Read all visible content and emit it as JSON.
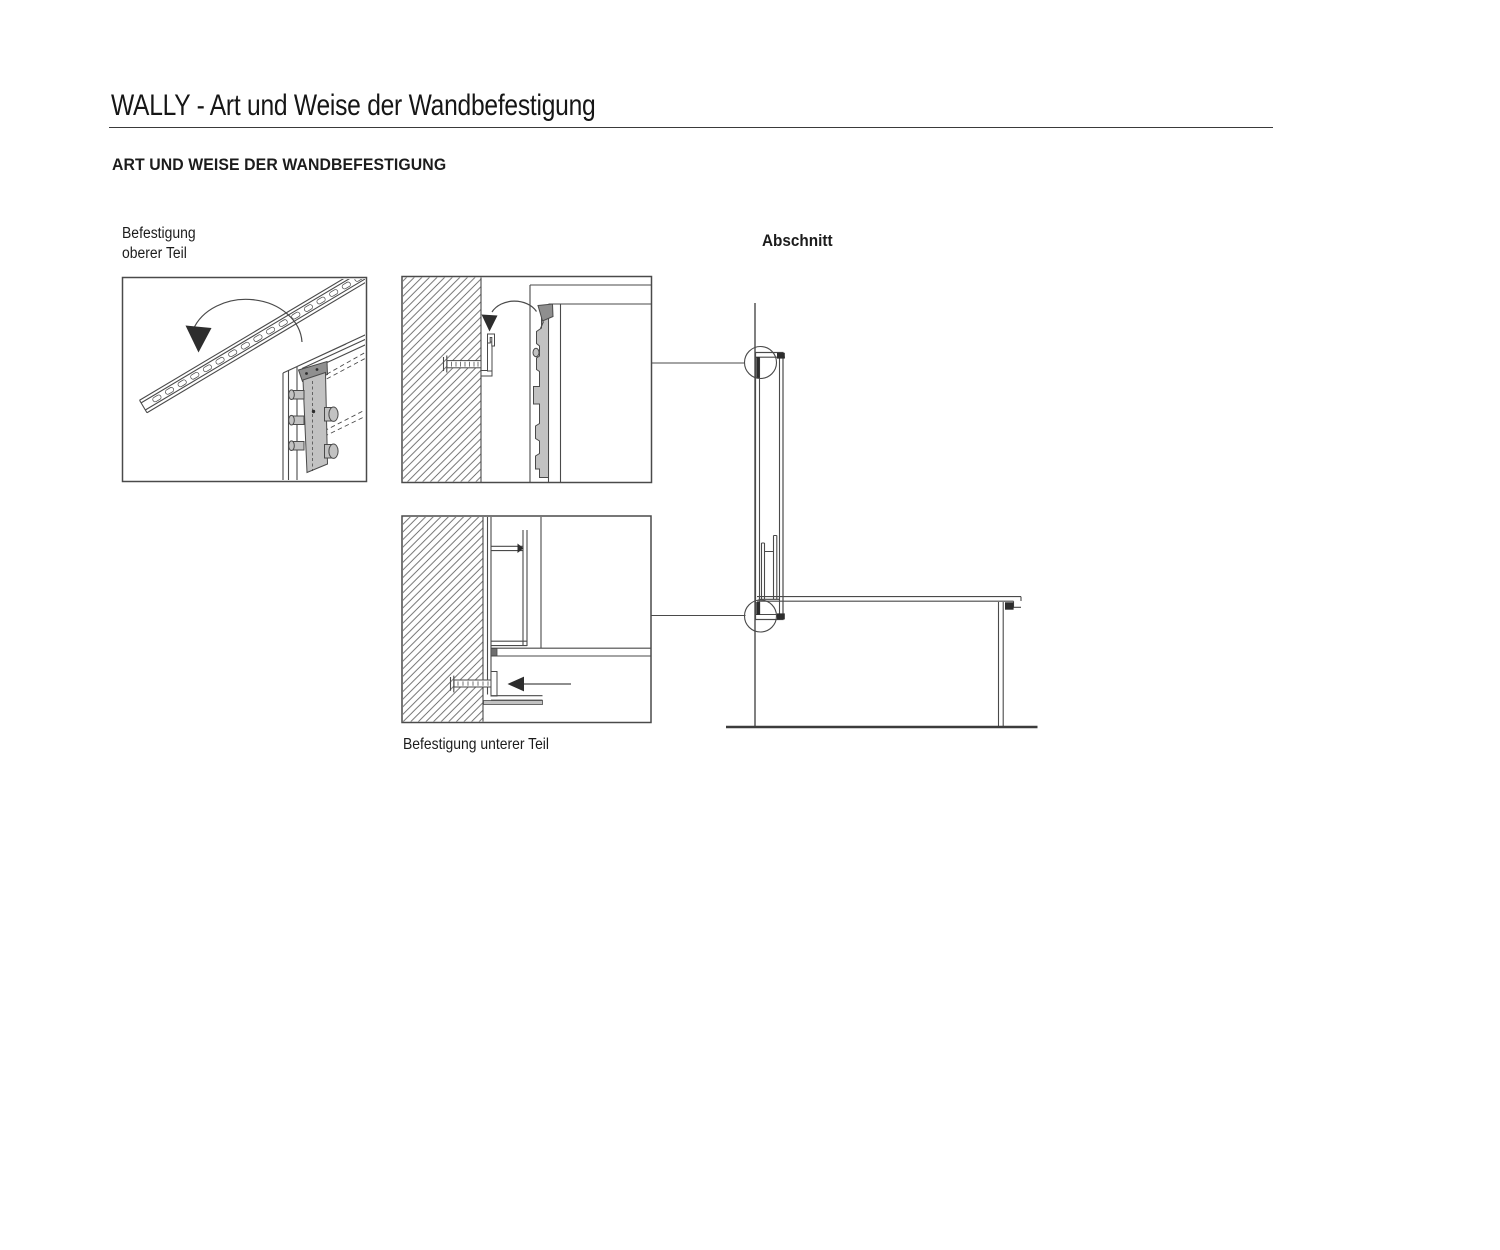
{
  "header": {
    "title": "WALLY - Art und Weise der Wandbefestigung",
    "heading": "ART UND WEISE DER WANDBEFESTIGUNG"
  },
  "labels": {
    "upper_fixing_line1": "Befestigung",
    "upper_fixing_line2": "oberer Teil",
    "section": "Abschnitt",
    "lower_fixing": "Befestigung unterer Teil"
  },
  "colors": {
    "text": "#1c1c1c",
    "line": "#4a4a4a",
    "dark": "#2d2d2d",
    "gray_light": "#c2c2c2",
    "gray_mid": "#8f8f8f",
    "paper": "#ffffff"
  }
}
